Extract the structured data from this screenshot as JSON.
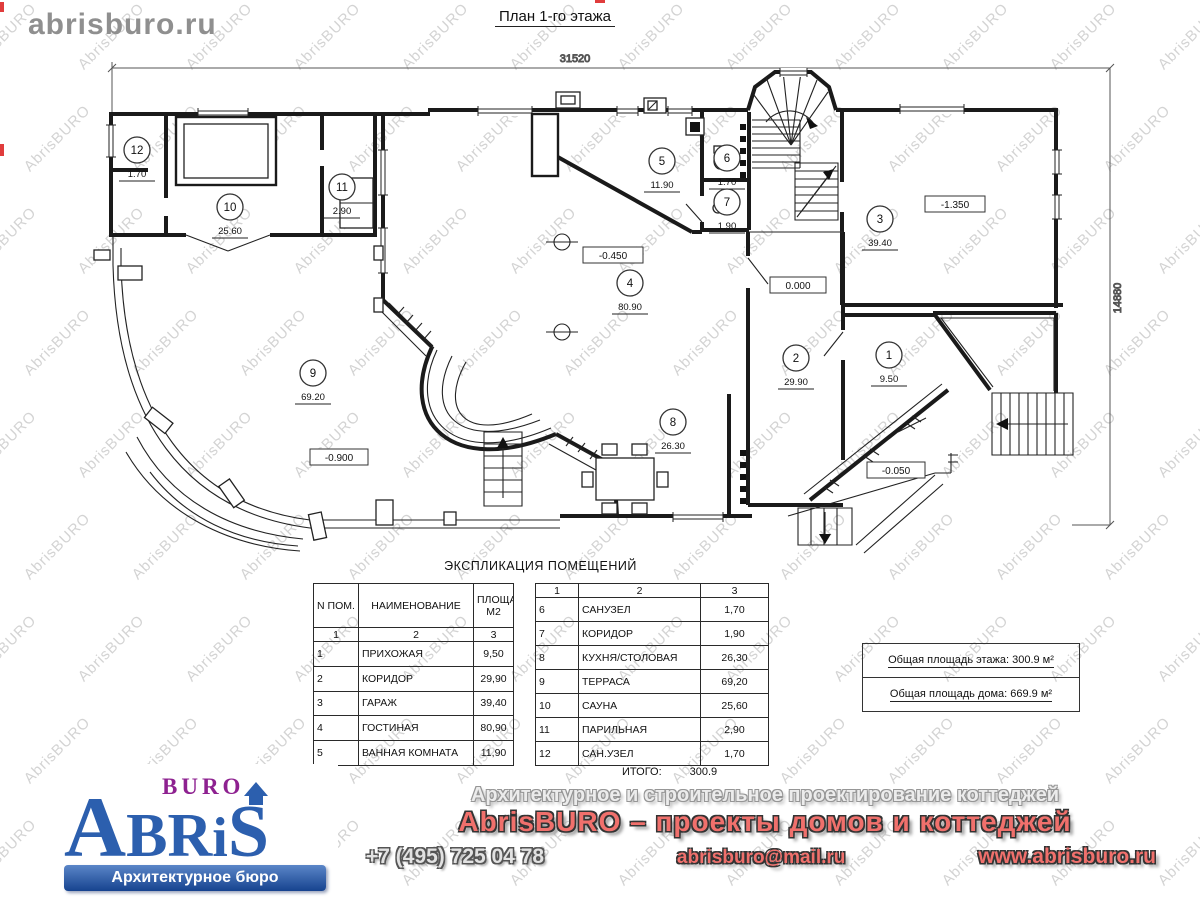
{
  "site_label": "abrisburo.ru",
  "watermark": {
    "text": "AbrisBURO"
  },
  "plan": {
    "title": "План 1-го этажа",
    "dim_top": "31520",
    "dim_right": "14880",
    "rooms": [
      {
        "num": "1",
        "area": "9.50"
      },
      {
        "num": "2",
        "area": "29.90"
      },
      {
        "num": "3",
        "area": "39.40"
      },
      {
        "num": "4",
        "area": "80.90"
      },
      {
        "num": "5",
        "area": "11.90"
      },
      {
        "num": "6",
        "area": "1.70"
      },
      {
        "num": "7",
        "area": "1.90"
      },
      {
        "num": "8",
        "area": "26.30"
      },
      {
        "num": "9",
        "area": "69.20"
      },
      {
        "num": "10",
        "area": "25.60"
      },
      {
        "num": "11",
        "area": "2.90"
      },
      {
        "num": "12",
        "area": "1.70"
      }
    ],
    "levels": [
      "-0.450",
      "0.000",
      "-1.350",
      "-0.900",
      "-0.050"
    ]
  },
  "table": {
    "title": "ЭКСПЛИКАЦИЯ ПОМЕЩЕНИЙ",
    "headers": {
      "col1": "N ПОМ.",
      "col2": "НАИМЕНОВАНИЕ",
      "col3": "ПЛОЩАДЬ М2"
    },
    "col_nums": [
      "1",
      "2",
      "3"
    ],
    "left_rows": [
      [
        "1",
        "ПРИХОЖАЯ",
        "9,50"
      ],
      [
        "2",
        "КОРИДОР",
        "29,90"
      ],
      [
        "3",
        "ГАРАЖ",
        "39,40"
      ],
      [
        "4",
        "ГОСТИНАЯ",
        "80,90"
      ],
      [
        "5",
        "ВАННАЯ КОМНАТА",
        "11,90"
      ]
    ],
    "right_rows": [
      [
        "6",
        "САНУЗЕЛ",
        "1,70"
      ],
      [
        "7",
        "КОРИДОР",
        "1,90"
      ],
      [
        "8",
        "КУХНЯ/СТОЛОВАЯ",
        "26,30"
      ],
      [
        "9",
        "ТЕРРАСА",
        "69,20"
      ],
      [
        "10",
        "САУНА",
        "25,60"
      ],
      [
        "11",
        "ПАРИЛЬНАЯ",
        "2,90"
      ],
      [
        "12",
        "САН.УЗЕЛ",
        "1,70"
      ]
    ],
    "total_label": "ИТОГО:",
    "total_value": "300.9"
  },
  "summary": {
    "floor": "Общая площадь этажа: 300.9 м²",
    "house": "Общая площадь дома: 669.9 м²"
  },
  "logo": {
    "buro": "BURO",
    "letter_a": "A",
    "letters_br": "BR",
    "letter_i": "i",
    "letter_s": "S",
    "tagline": "Архитектурное бюро"
  },
  "footer": {
    "line1": "Архитектурное и строительное проектирование коттеджей",
    "line2": "AbrisBURO – проекты домов и коттеджей",
    "phone": "+7 (495) 725 04 78",
    "email": "abrisburo@mail.ru",
    "site": "www.abrisburo.ru"
  },
  "colors": {
    "accent_blue": "#2c5fae",
    "accent_purple": "#8e2190",
    "accent_red": "#f0706c"
  }
}
